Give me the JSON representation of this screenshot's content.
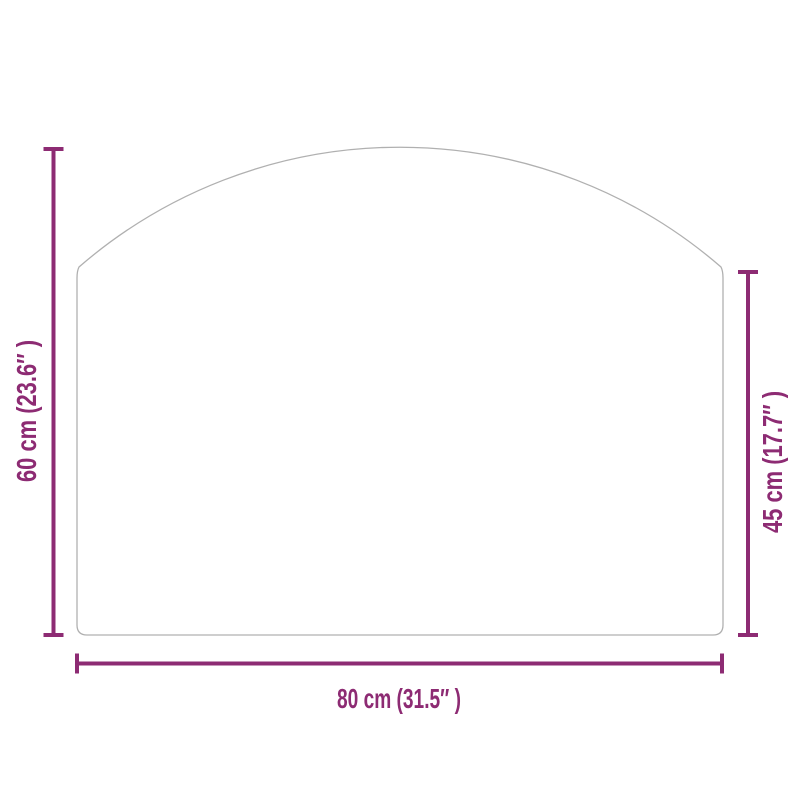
{
  "diagram": {
    "colors": {
      "dimension": "#8d2b73",
      "outline": "#b0b0b0",
      "background": "#ffffff"
    },
    "labels": {
      "total_height": "60 cm (23.6″ )",
      "side_height": "45 cm (17.7″ )",
      "width": "80 cm (31.5″ )"
    }
  }
}
